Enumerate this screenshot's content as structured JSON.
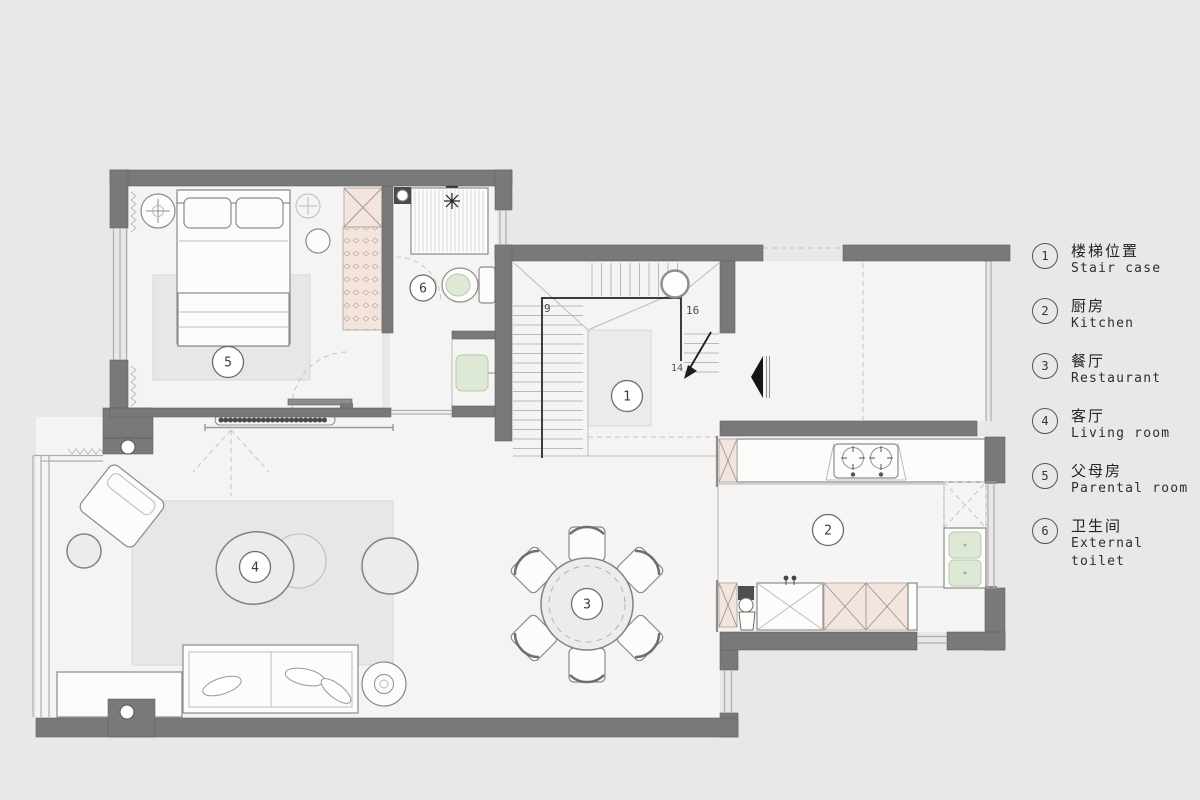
{
  "legend": {
    "items": [
      {
        "number": "1",
        "zh": "楼梯位置",
        "en": "Stair case"
      },
      {
        "number": "2",
        "zh": "厨房",
        "en": "Kitchen"
      },
      {
        "number": "3",
        "zh": "餐厅",
        "en": "Restaurant"
      },
      {
        "number": "4",
        "zh": "客厅",
        "en": "Living room"
      },
      {
        "number": "5",
        "zh": "父母房",
        "en": "Parental room"
      },
      {
        "number": "6",
        "zh": "卫生间",
        "en": "External toilet"
      }
    ]
  },
  "plan": {
    "room_labels": {
      "staircase": "1",
      "kitchen": "2",
      "restaurant": "3",
      "living_room": "4",
      "parental_room": "5",
      "external_toilet": "6"
    },
    "stair_numbers": {
      "upper": "9",
      "landing": "16",
      "lower": "14"
    }
  },
  "colors": {
    "background": "#e9e8e7",
    "wall": "#7a7979",
    "floor": "#f5f4f3",
    "cabinet_pink": "#f3e5de",
    "fixture_green": "#dde8d5"
  }
}
